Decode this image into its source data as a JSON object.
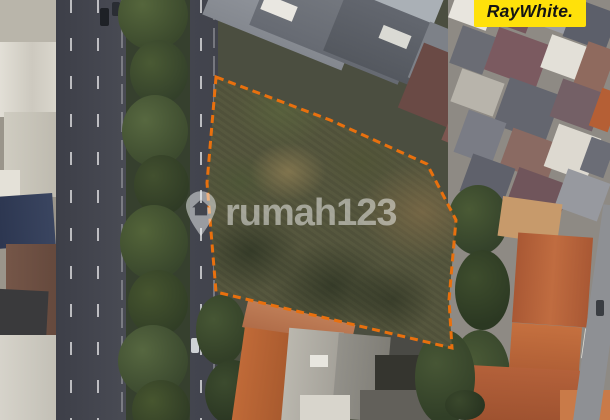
{
  "branding": {
    "agency_logo_text": "RayWhite.",
    "agency_logo_bg": "#FFE10A",
    "agency_logo_color": "#141414"
  },
  "watermark": {
    "icon": "map-pin-house-icon",
    "text": "rumah123",
    "color": "rgba(255,255,255,0.48)"
  },
  "map": {
    "description": "aerial-satellite-photo-of-vacant-lot",
    "boundary": {
      "color": "#E8700E",
      "stroke_width": "3",
      "dash": "8 5",
      "points": "216,77 330,120 427,164 456,220 449,300 452,348 216,292 207,183"
    }
  }
}
